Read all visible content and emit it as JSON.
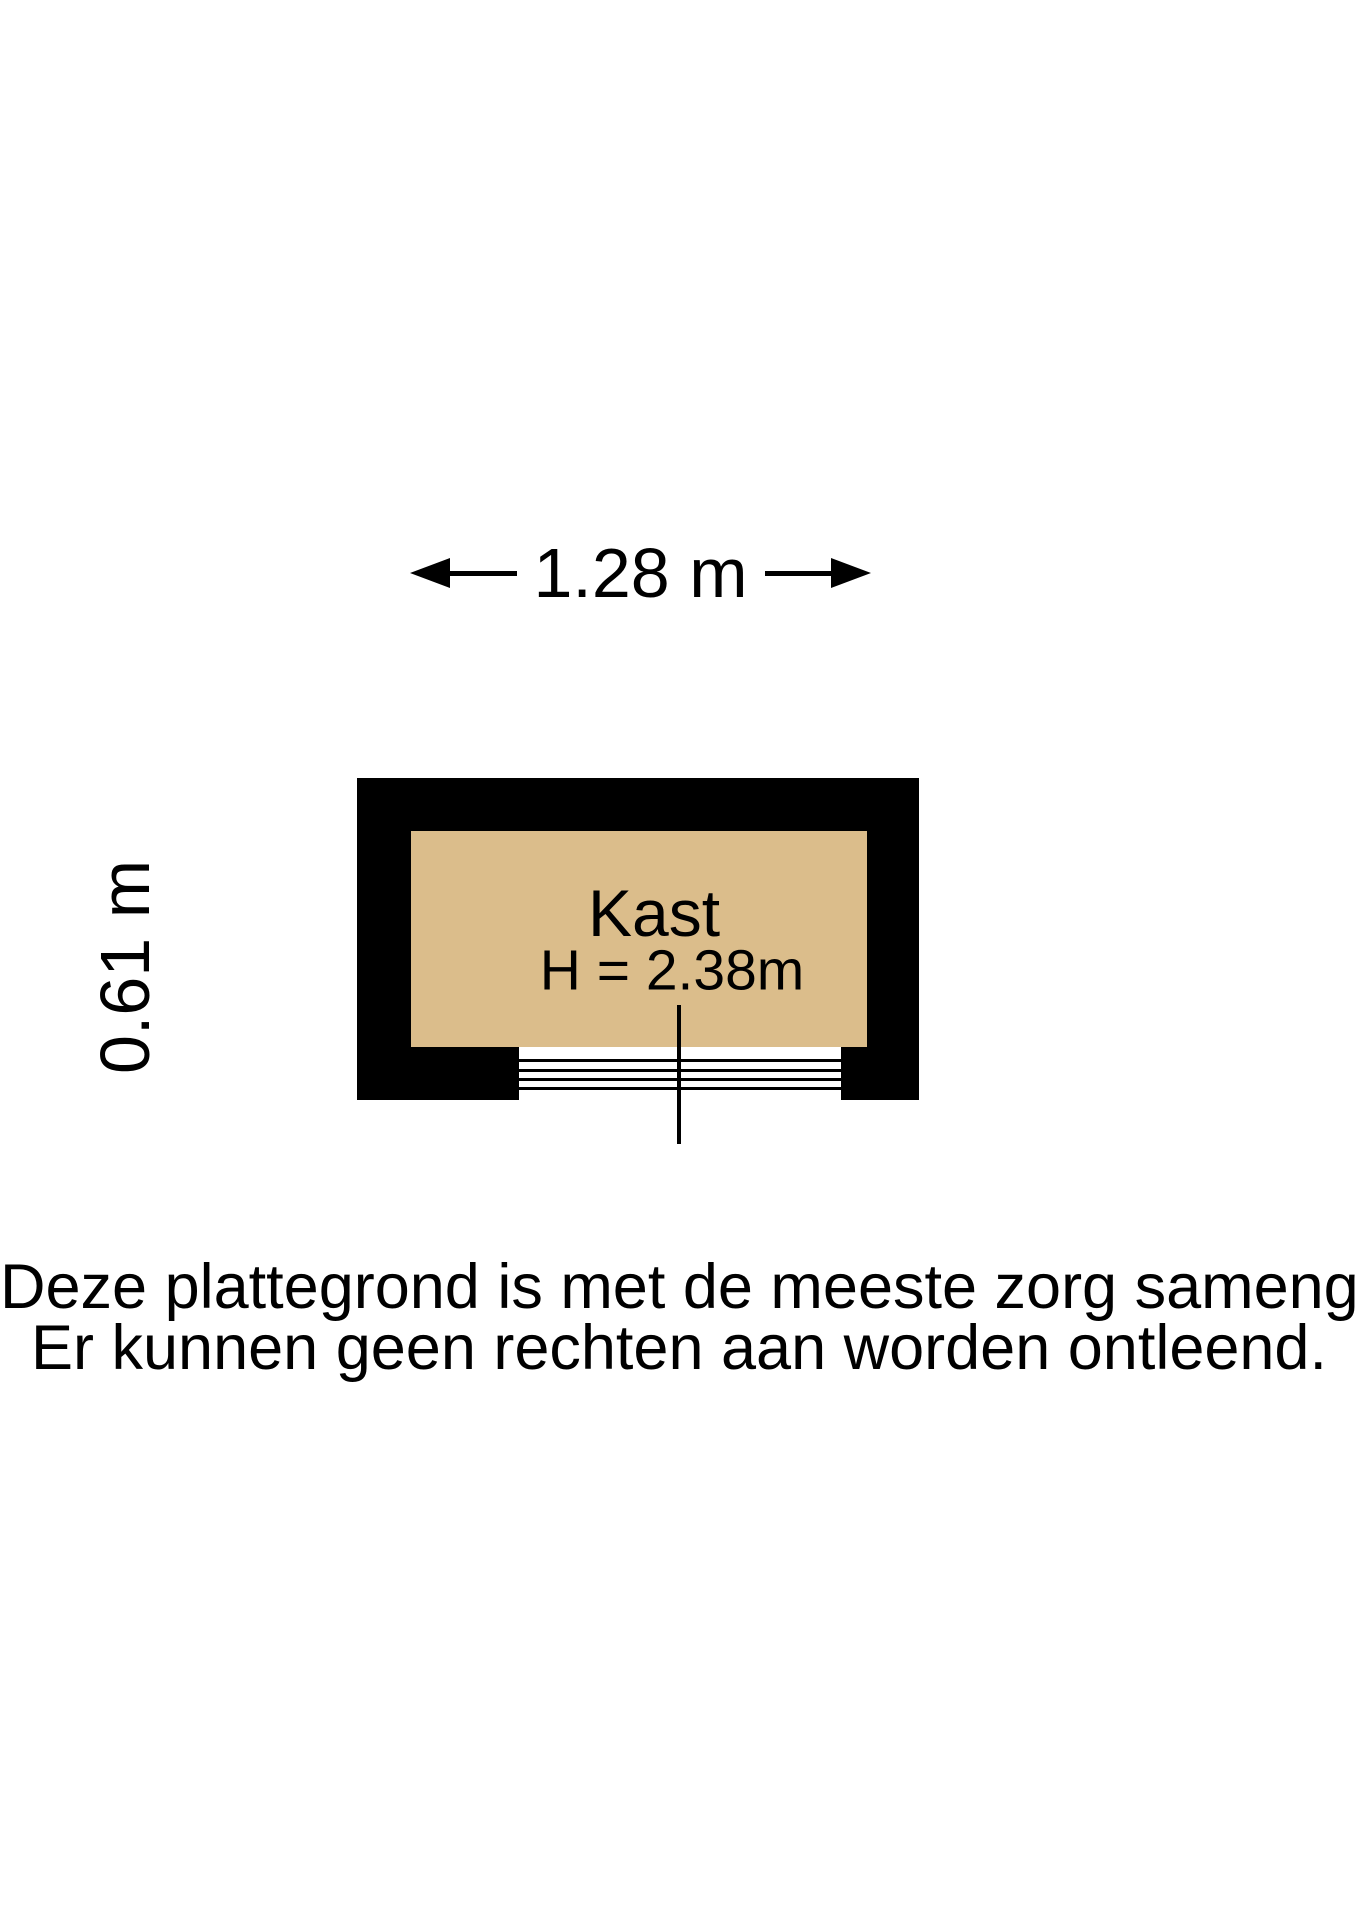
{
  "floorplan": {
    "room_label": "Kast",
    "room_height_label": "H = 2.38m",
    "width_dimension": "1.28 m",
    "depth_dimension": "0.61 m",
    "colors": {
      "wall": "#000000",
      "floor": "#dbbd8b",
      "text": "#000000",
      "background": "#ffffff"
    },
    "icons": {
      "left_arrow": "dimension-arrow-left-icon",
      "right_arrow": "dimension-arrow-right-icon"
    }
  },
  "disclaimer": {
    "line1": "Deze plattegrond is met de meeste zorg samengesteld.",
    "line2": "Er kunnen geen rechten aan worden ontleend."
  }
}
